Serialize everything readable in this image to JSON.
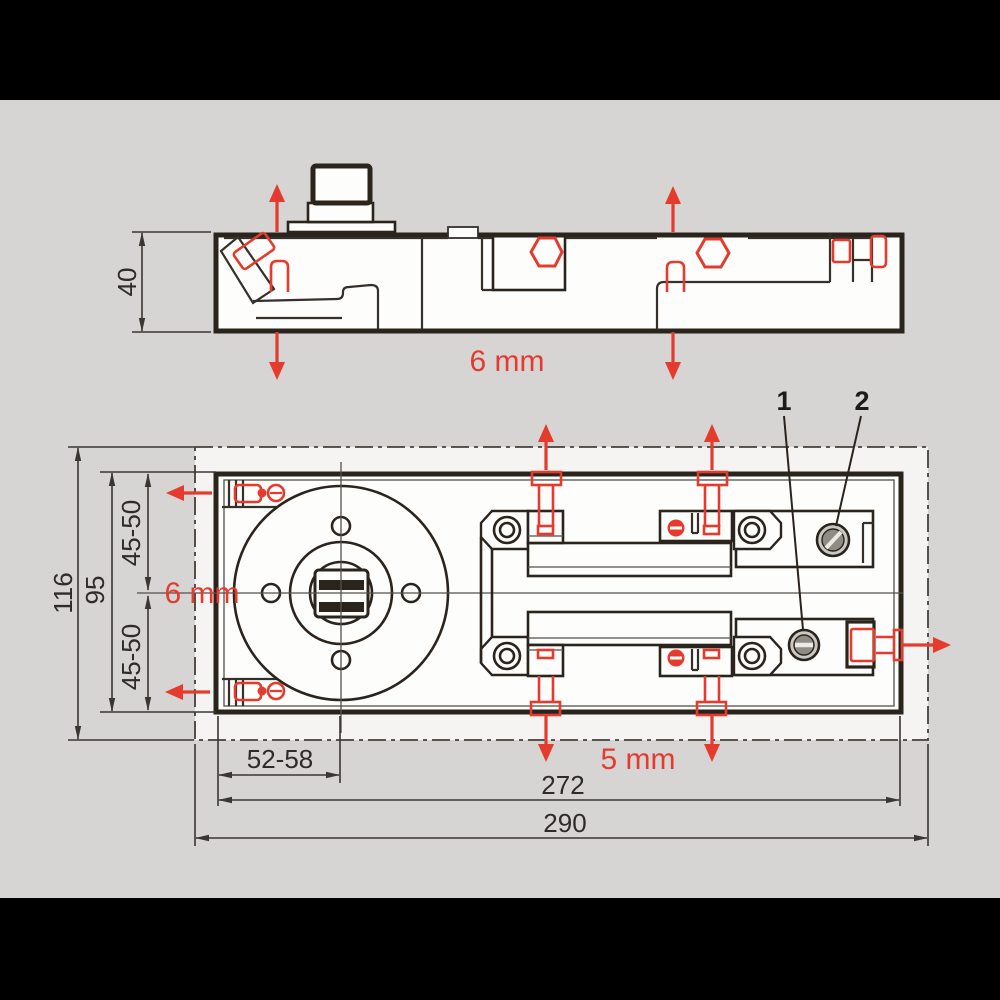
{
  "colors": {
    "background": "#000000",
    "sheet": "#d6d5d3",
    "drawing_area": "#f5f4f2",
    "line": "#2b241d",
    "accent_red": "#e53a2e"
  },
  "side_view": {
    "height_mm": "40",
    "vertical_adjust_label": "6 mm"
  },
  "plan_view": {
    "overall_width_mm": "116",
    "body_width_mm": "95",
    "axis_range_top": "45-50",
    "axis_range_bottom": "45-50",
    "spindle_inset_range": "52-58",
    "body_length_mm": "272",
    "overall_length_mm": "290",
    "lateral_adjust_label": "6 mm",
    "longitudinal_adjust_label": "5 mm",
    "callout_1": "1",
    "callout_2": "2"
  }
}
